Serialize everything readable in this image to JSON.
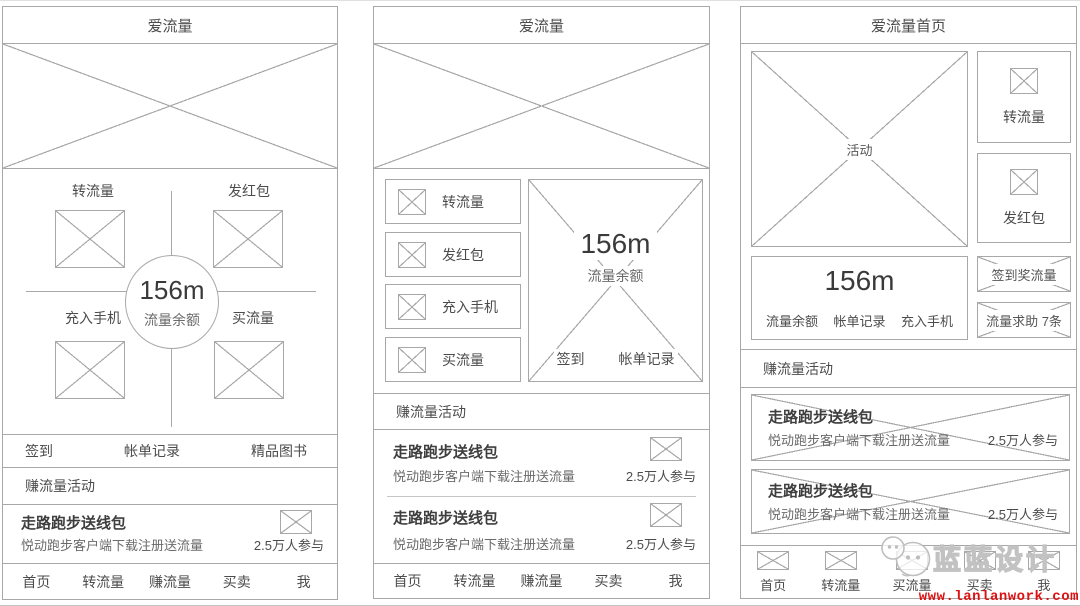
{
  "colors": {
    "line": "#a8a8a8",
    "text": "#4c4c4c",
    "url_red": "#dd1111",
    "watermark_gray": "#c2c2c2"
  },
  "screen1": {
    "title": "爱流量",
    "actions": {
      "top_left": "转流量",
      "top_right": "发红包",
      "bottom_left": "充入手机",
      "bottom_right": "买流量"
    },
    "balance": {
      "value": "156m",
      "label": "流量余额"
    },
    "quick_links": [
      "签到",
      "帐单记录",
      "精品图书"
    ],
    "section_title": "赚流量活动",
    "promo": {
      "title": "走路跑步送线包",
      "subtitle": "悦动跑步客户端下载注册送流量",
      "participants": "2.5万人参与"
    },
    "nav": [
      "首页",
      "转流量",
      "赚流量",
      "买卖",
      "我"
    ]
  },
  "screen2": {
    "title": "爱流量",
    "menu": [
      "转流量",
      "发红包",
      "充入手机",
      "买流量"
    ],
    "balance": {
      "value": "156m",
      "label": "流量余额",
      "links": [
        "签到",
        "帐单记录"
      ]
    },
    "section_title": "赚流量活动",
    "promos": [
      {
        "title": "走路跑步送线包",
        "subtitle": "悦动跑步客户端下载注册送流量",
        "participants": "2.5万人参与"
      },
      {
        "title": "走路跑步送线包",
        "subtitle": "悦动跑步客户端下载注册送流量",
        "participants": "2.5万人参与"
      }
    ],
    "nav": [
      "首页",
      "转流量",
      "赚流量",
      "买卖",
      "我"
    ]
  },
  "screen3": {
    "title": "爱流量首页",
    "banner_label": "活动",
    "side_actions": [
      "转流量",
      "发红包"
    ],
    "balance": {
      "value": "156m",
      "links": [
        "流量余额",
        "帐单记录",
        "充入手机"
      ]
    },
    "side_buttons": [
      "签到奖流量",
      "流量求助 7条"
    ],
    "section_title": "赚流量活动",
    "promos": [
      {
        "title": "走路跑步送线包",
        "subtitle": "悦动跑步客户端下载注册送流量",
        "participants": "2.5万人参与"
      },
      {
        "title": "走路跑步送线包",
        "subtitle": "悦动跑步客户端下载注册送流量",
        "participants": "2.5万人参与"
      }
    ],
    "nav": [
      "首页",
      "转流量",
      "买流量",
      "买卖",
      "我"
    ]
  },
  "watermark": {
    "brand": "蓝蓝设计",
    "url": "www.lanlanwork.com"
  }
}
